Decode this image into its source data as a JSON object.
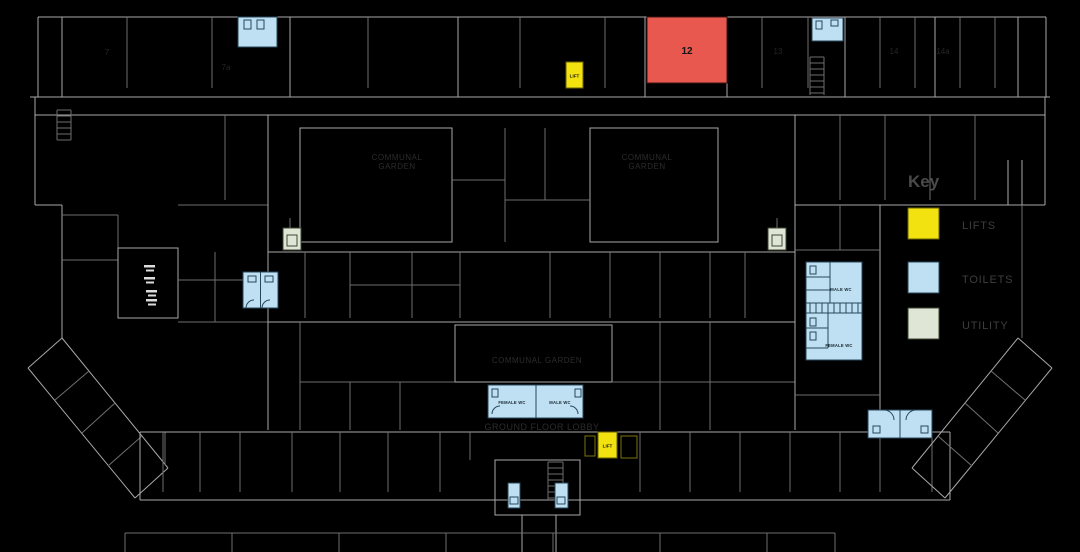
{
  "canvas": {
    "width": 1080,
    "height": 552,
    "background": "#000000"
  },
  "colors": {
    "background": "#000000",
    "wall": "#a8a8a8",
    "lift": "#f2e20f",
    "toilet": "#bfe0f2",
    "utility": "#dfe6d6",
    "highlight_room": "#e8584e",
    "dark_label": "#2c2c2c",
    "legend_title_text": "#4a4a4a",
    "legend_label_text": "#3e3e3e",
    "white_marker": "#dcdcdc"
  },
  "legend": {
    "title": "Key",
    "items": [
      {
        "id": "lifts",
        "label": "LIFTS",
        "color": "#f2e20f"
      },
      {
        "id": "toilets",
        "label": "TOILETS",
        "color": "#bfe0f2"
      },
      {
        "id": "utility",
        "label": "UTILITY",
        "color": "#dfe6d6"
      }
    ]
  },
  "rooms": {
    "highlighted_room_number": "12",
    "lift_label": "LIFT",
    "male_wc_label": "MALE WC",
    "female_wc_label": "FEMALE WC"
  },
  "room_numbers": {
    "r7": "7",
    "r7a": "7a",
    "r13": "13",
    "r14": "14",
    "r14a": "14a"
  },
  "area_labels": {
    "communal_garden_line1": "COMMUNAL",
    "communal_garden_line2": "GARDEN",
    "communal_garden_single": "COMMUNAL GARDEN",
    "ground_floor_lobby": "GROUND FLOOR LOBBY"
  }
}
